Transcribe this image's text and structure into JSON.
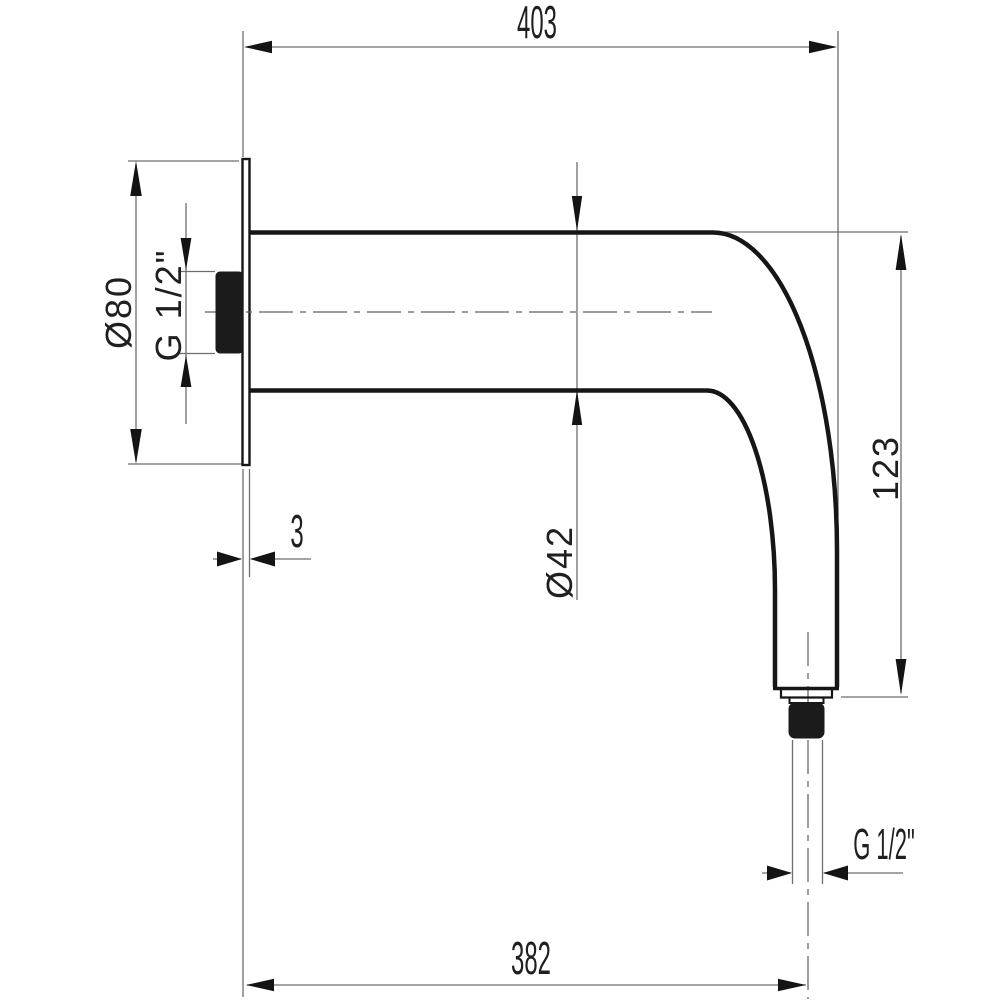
{
  "drawing": {
    "type": "technical-dimension-drawing",
    "subject": "wall-mounted shower arm, side view",
    "background_color": "#ffffff",
    "object_line_color": "#161616",
    "dimension_line_color": "#6e6e6e",
    "labels": {
      "length_overall": "403",
      "length_to_outlet_center": "382",
      "flange_diameter": "Ø80",
      "inlet_thread": "G 1/2\"",
      "arm_diameter": "Ø42",
      "drop_height": "123",
      "flange_thickness": "3",
      "outlet_thread": "G 1/2\""
    }
  }
}
